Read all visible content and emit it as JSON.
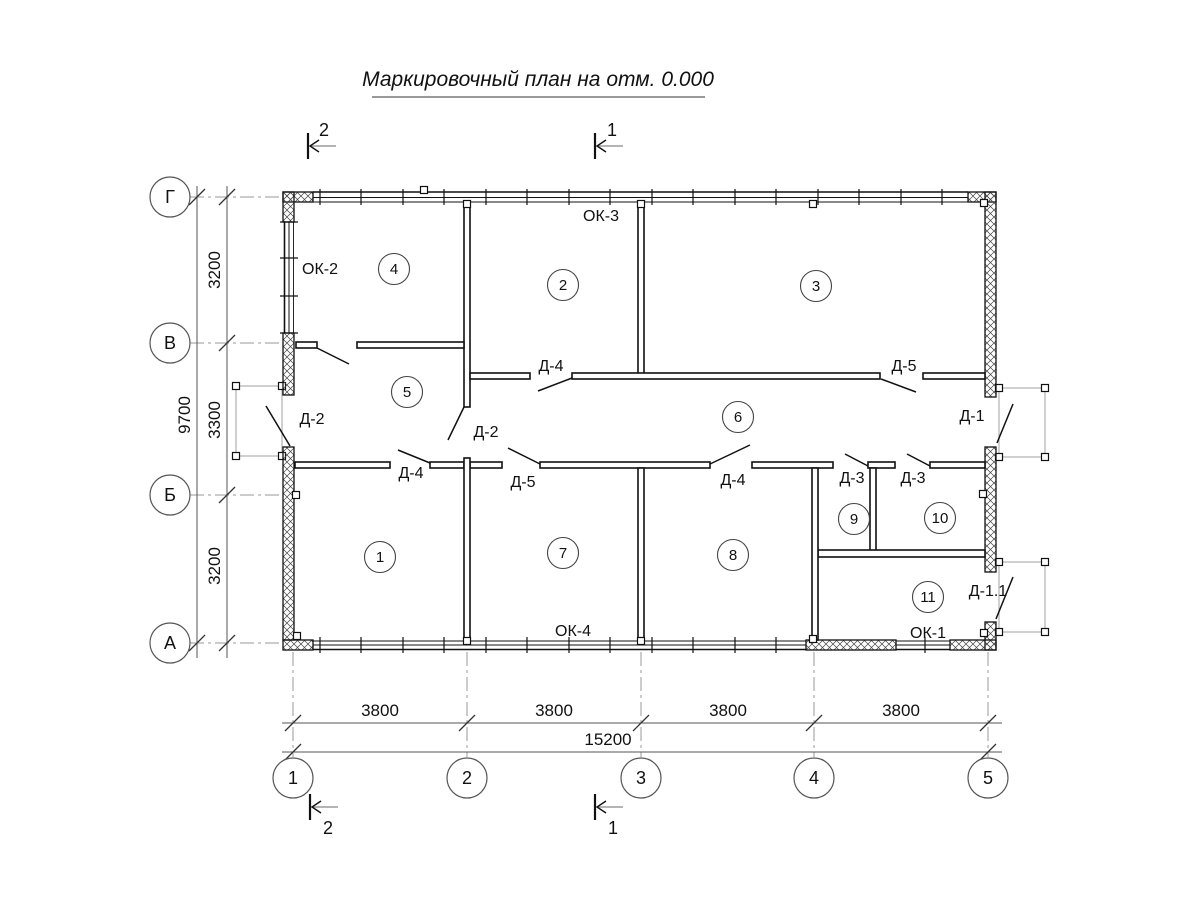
{
  "title": "Маркировочный план на отм. 0.000",
  "sections": {
    "s1": "1",
    "s2": "2"
  },
  "axes": {
    "rows": [
      "Г",
      "В",
      "Б",
      "А"
    ],
    "cols": [
      "1",
      "2",
      "3",
      "4",
      "5"
    ]
  },
  "dimensions": {
    "col_spans": [
      "3800",
      "3800",
      "3800",
      "3800"
    ],
    "col_total": "15200",
    "row_spans": [
      "3200",
      "3300",
      "3200"
    ],
    "row_total": "9700"
  },
  "rooms": [
    "1",
    "2",
    "3",
    "4",
    "5",
    "6",
    "7",
    "8",
    "9",
    "10",
    "11"
  ],
  "doors": {
    "d1": "Д-1",
    "d1_1": "Д-1.1",
    "d2": "Д-2",
    "d3": "Д-3",
    "d4": "Д-4",
    "d5": "Д-5"
  },
  "windows": {
    "ok1": "ОК-1",
    "ok2": "ОК-2",
    "ok3": "ОК-3",
    "ok4": "ОК-4"
  },
  "colors": {
    "line": "#111111",
    "dim_line": "#555555",
    "axis_line": "#999999",
    "porch_outline": "#b0b0b0",
    "background": "#ffffff"
  }
}
